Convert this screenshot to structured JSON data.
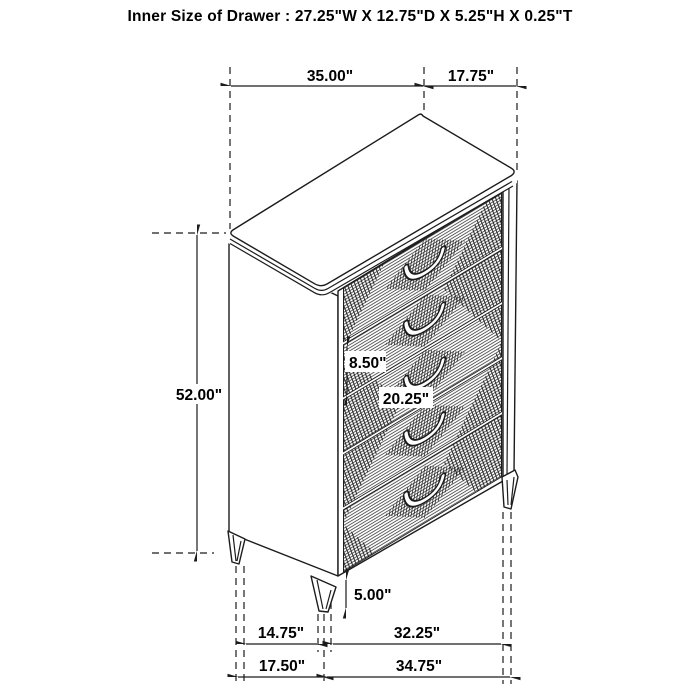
{
  "title": "Inner Size of Drawer : 27.25\"W X 12.75\"D X 5.25\"H X 0.25\"T",
  "dimensions": {
    "top_width": "35.00\"",
    "top_depth": "17.75\"",
    "overall_height": "52.00\"",
    "drawer_face_height": "8.50\"",
    "drawer_face_width": "20.25\"",
    "leg_height": "5.00\"",
    "front_leg_spacing": "14.75\"",
    "side_leg_spacing": "32.25\"",
    "front_base_width": "17.50\"",
    "side_base_width": "34.75\""
  },
  "figure": {
    "type": "5-drawer chest, isometric line drawing",
    "drawer_count": 5,
    "visible_legs": 3,
    "texture": "diagonal-hatch argyle diamond pattern on drawer fronts"
  },
  "colors": {
    "background": "#ffffff",
    "line": "#1c1c1c",
    "text": "#000000"
  }
}
